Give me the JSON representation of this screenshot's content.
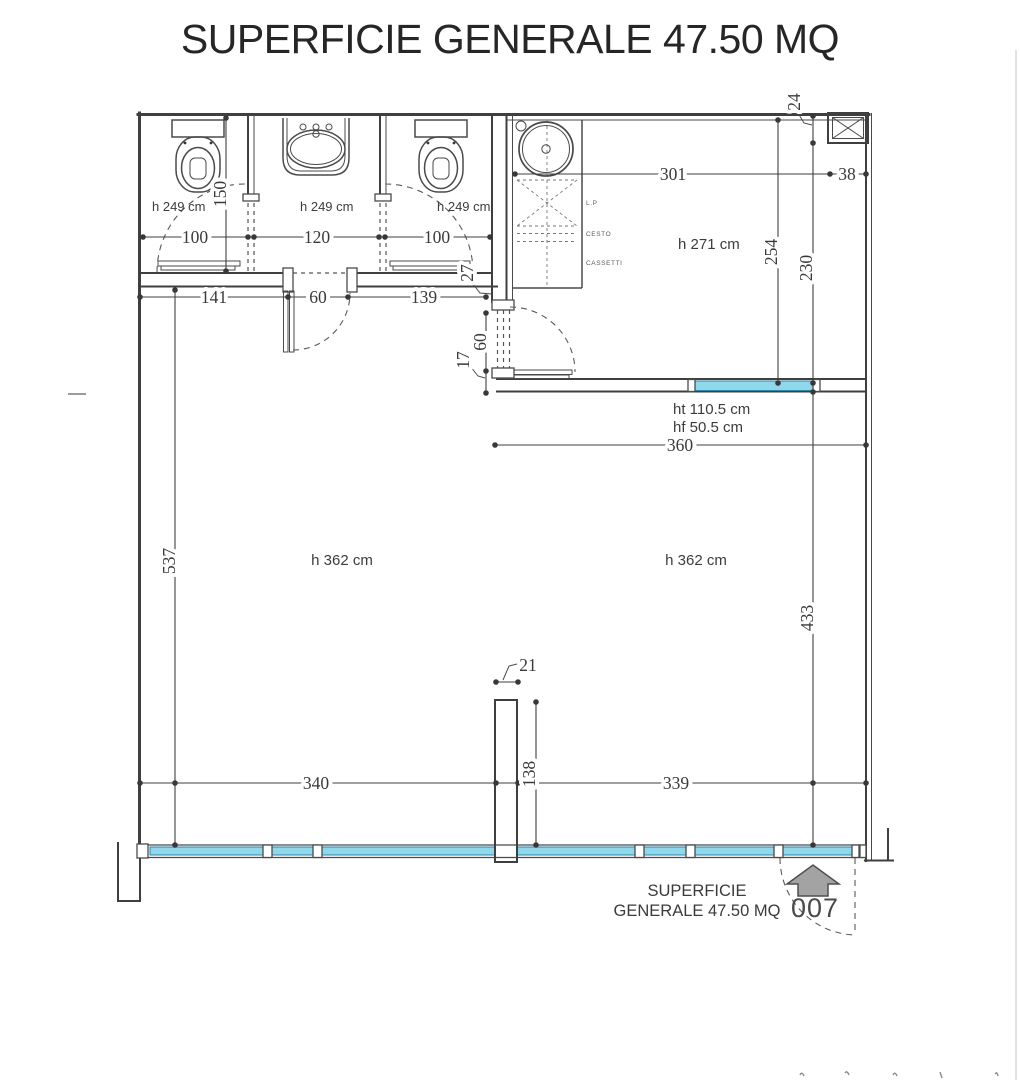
{
  "title": "SUPERFICIE GENERALE 47.50 MQ",
  "bathrooms": {
    "left": {
      "ceiling": "h 249 cm",
      "width": "100"
    },
    "middle": {
      "ceiling": "h 249 cm",
      "width": "120"
    },
    "right": {
      "ceiling": "h 249 cm",
      "width": "100"
    },
    "depth": "150",
    "front_wall": {
      "left": "141",
      "door": "60",
      "right": "139",
      "corner": "27"
    }
  },
  "kitchen": {
    "ceiling": "h 271 cm",
    "width": "301",
    "shaft_gap": "38",
    "shaft_depth": "24",
    "depth_left": "254",
    "depth_right": "230",
    "door_width": "60",
    "door_jamb": "17",
    "cabinet": {
      "top": "L.P",
      "middle": "CESTO",
      "bottom": "CASSETTI"
    }
  },
  "internal_window": {
    "ht": "ht 110.5 cm",
    "hf": "hf 50.5 cm",
    "width": "360"
  },
  "living_room": {
    "ceiling_left": "h 362 cm",
    "ceiling_right": "h 362 cm",
    "depth_left": "537",
    "depth_right": "433",
    "bottom_left": "340",
    "bottom_right": "339",
    "pillar_width": "21",
    "pillar_offset": "138"
  },
  "footer": {
    "caption_line1": "SUPERFICIE",
    "caption_line2": "GENERALE 47.50 MQ",
    "unit_number": "007"
  },
  "colors": {
    "ink": "#3f3f3f",
    "window_glass": "#8fd7ea",
    "window_edge": "#2e86a8",
    "arrow_fill": "#a3a3a3"
  }
}
